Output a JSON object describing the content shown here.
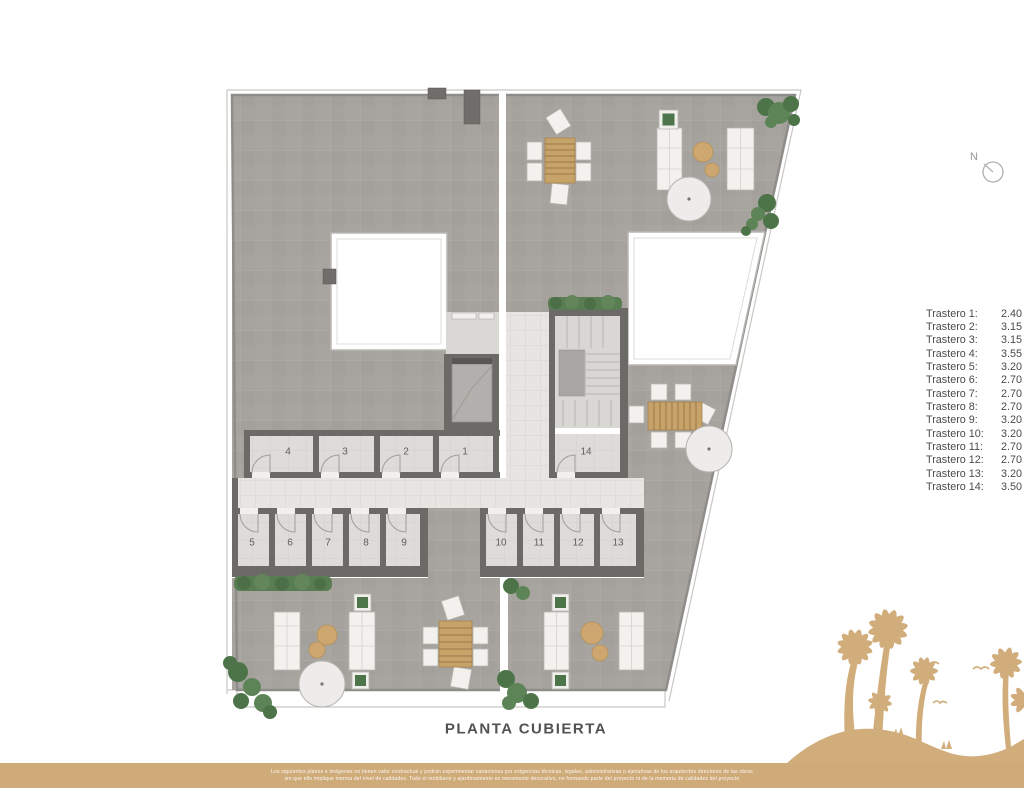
{
  "page": {
    "title": "PLANTA CUBIERTA"
  },
  "north": {
    "label": "N"
  },
  "plan": {
    "rooms": [
      "1",
      "2",
      "3",
      "4",
      "5",
      "6",
      "7",
      "8",
      "9",
      "10",
      "11",
      "12",
      "13",
      "14"
    ]
  },
  "legend": {
    "items": [
      {
        "name": "Trastero 1:",
        "value": "2.40"
      },
      {
        "name": "Trastero 2:",
        "value": "3.15"
      },
      {
        "name": "Trastero 3:",
        "value": "3.15"
      },
      {
        "name": "Trastero 4:",
        "value": "3.55"
      },
      {
        "name": "Trastero 5:",
        "value": "3.20"
      },
      {
        "name": "Trastero 6:",
        "value": "2.70"
      },
      {
        "name": "Trastero 7:",
        "value": "2.70"
      },
      {
        "name": "Trastero 8:",
        "value": "2.70"
      },
      {
        "name": "Trastero 9:",
        "value": "3.20"
      },
      {
        "name": "Trastero 10:",
        "value": "3.20"
      },
      {
        "name": "Trastero 11:",
        "value": "2.70"
      },
      {
        "name": "Trastero 12:",
        "value": "2.70"
      },
      {
        "name": "Trastero 13:",
        "value": "3.20"
      },
      {
        "name": "Trastero 14:",
        "value": "3.50"
      }
    ]
  },
  "footer": {
    "disclaimer_line1": "Los siguientes planos e imágenes no tienen valor contractual y podrán experimentar variaciones por exigencias técnicas, legales, administrativas o ejecutivas de los arquitectos directores de las obras",
    "disclaimer_line2": "sin que ello implique merma del nivel de calidades. Todo el mobiliario y ajardinamiento es meramente decorativo, no formando parte del proyecto ni de la memoria de calidades del proyecto"
  },
  "colors": {
    "accent_tan": "#d1ad7c",
    "terrace_gray": "#a6a39e",
    "wall_gray": "#6b6a67",
    "floor_light": "#e4e3e0",
    "hedge_green": "#597d53",
    "text_dark": "#4a4a4a"
  }
}
